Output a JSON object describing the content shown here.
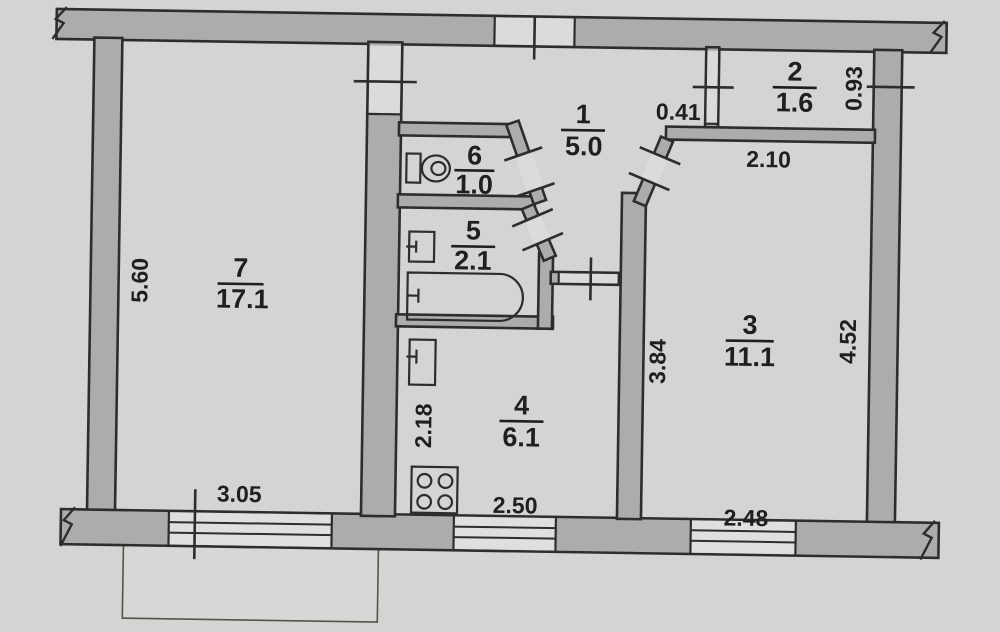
{
  "document": {
    "type": "floor-plan",
    "rooms": {
      "room1": {
        "number": "1",
        "area": "5.0"
      },
      "room2": {
        "number": "2",
        "area": "1.6"
      },
      "room3": {
        "number": "3",
        "area": "11.1"
      },
      "room4": {
        "number": "4",
        "area": "6.1"
      },
      "room5": {
        "number": "5",
        "area": "2.1"
      },
      "room6": {
        "number": "6",
        "area": "1.0"
      },
      "room7": {
        "number": "7",
        "area": "17.1"
      }
    },
    "dimensions": {
      "room7_height": "5.60",
      "room7_window": "3.05",
      "hall_nook": "0.41",
      "closet_depth": "0.93",
      "room3_top": "2.10",
      "room3_left": "3.84",
      "room3_right": "4.52",
      "room3_window": "2.48",
      "kitchen_window": "2.50",
      "kitchen_left": "2.18"
    },
    "fixtures": [
      "toilet",
      "washbasin",
      "bathtub",
      "kitchen-sink",
      "stove"
    ],
    "colors": {
      "paper": "#d5d4d2",
      "wall": "#adacaa",
      "line": "#2f2d2b",
      "text": "#201f1d"
    }
  }
}
